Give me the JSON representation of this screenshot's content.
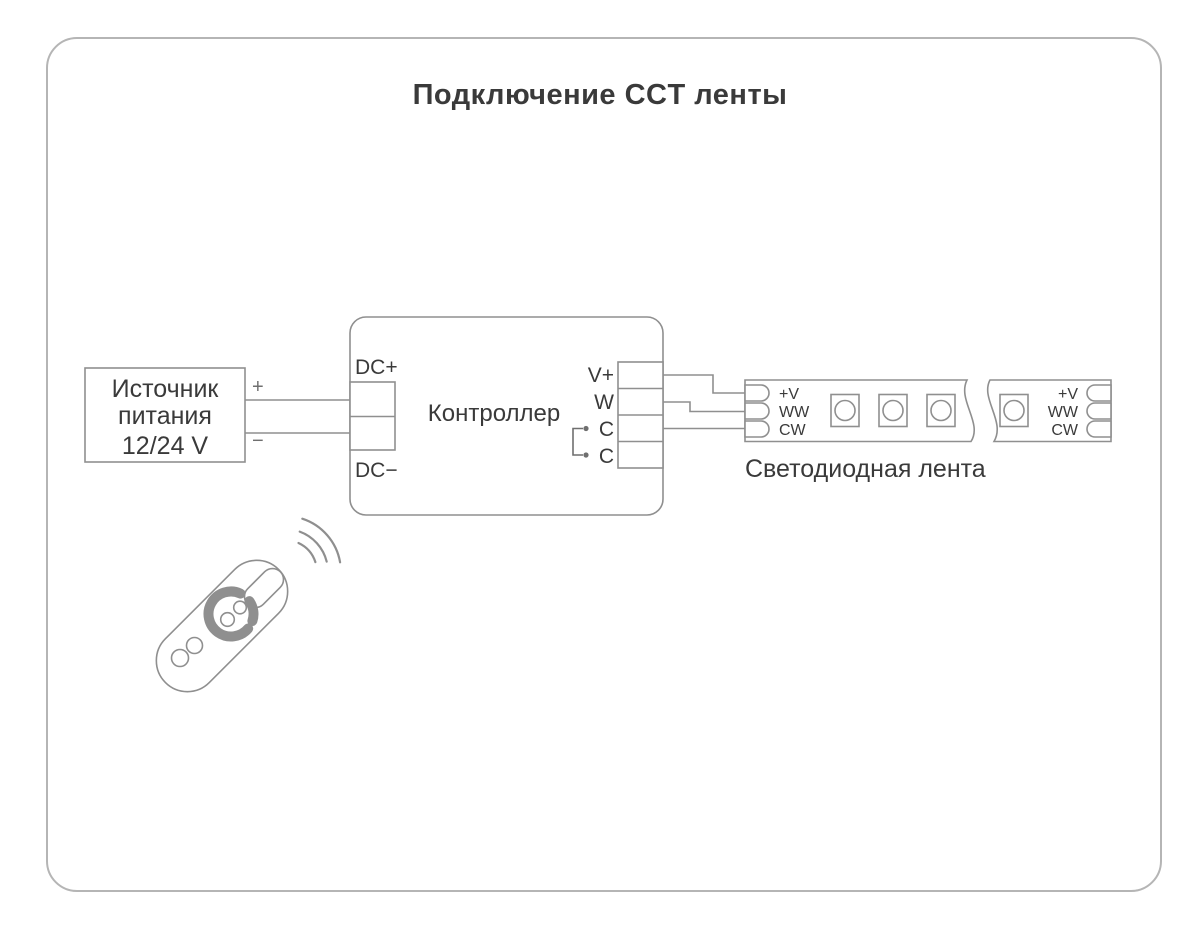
{
  "title": "Подключение CCT ленты",
  "colors": {
    "line": "#8f8f8f",
    "text": "#3a3a3a",
    "muted": "#6f6f6f",
    "card_border": "#b5b5b5",
    "background": "#ffffff"
  },
  "power_supply": {
    "name_line1": "Источник",
    "name_line2": "питания",
    "voltage": "12/24 V",
    "plus_label": "+",
    "minus_label": "−"
  },
  "controller": {
    "label": "Контроллер",
    "input_plus": "DC+",
    "input_minus": "DC−",
    "outputs": [
      "V+",
      "W",
      "C",
      "C"
    ]
  },
  "led_strip": {
    "label": "Светодиодная лента",
    "left_pads": [
      "+V",
      "WW",
      "CW"
    ],
    "right_pads": [
      "+V",
      "WW",
      "CW"
    ]
  }
}
